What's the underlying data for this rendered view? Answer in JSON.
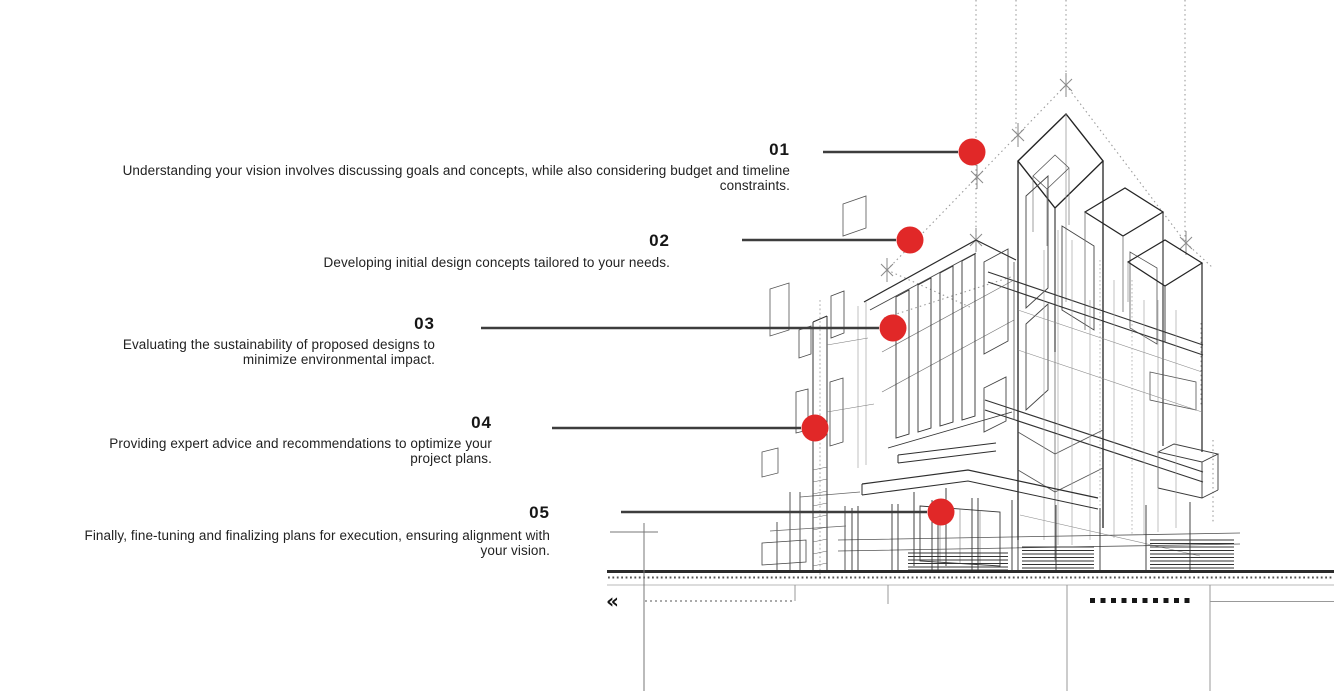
{
  "title": "Design process infographic",
  "illustration": {
    "name": "architectural wireframe building sketch",
    "back_chevrons": "«"
  },
  "colors": {
    "accent_red": "#e12828",
    "connector_line": "#3d3d3d",
    "ink": "#1e1e1e",
    "sketch_dark": "#2a2a2a",
    "sketch_light": "#8a8a8a"
  },
  "steps": [
    {
      "number": "01",
      "description": "Understanding your vision involves discussing goals and concepts, while also considering budget and timeline constraints."
    },
    {
      "number": "02",
      "description": "Developing initial design concepts tailored to your needs."
    },
    {
      "number": "03",
      "description": "Evaluating the sustainability of proposed designs to minimize environmental impact."
    },
    {
      "number": "04",
      "description": "Providing expert advice and recommendations to optimize your project plans."
    },
    {
      "number": "05",
      "description": "Finally, fine-tuning and finalizing plans for execution, ensuring alignment with your vision."
    }
  ]
}
